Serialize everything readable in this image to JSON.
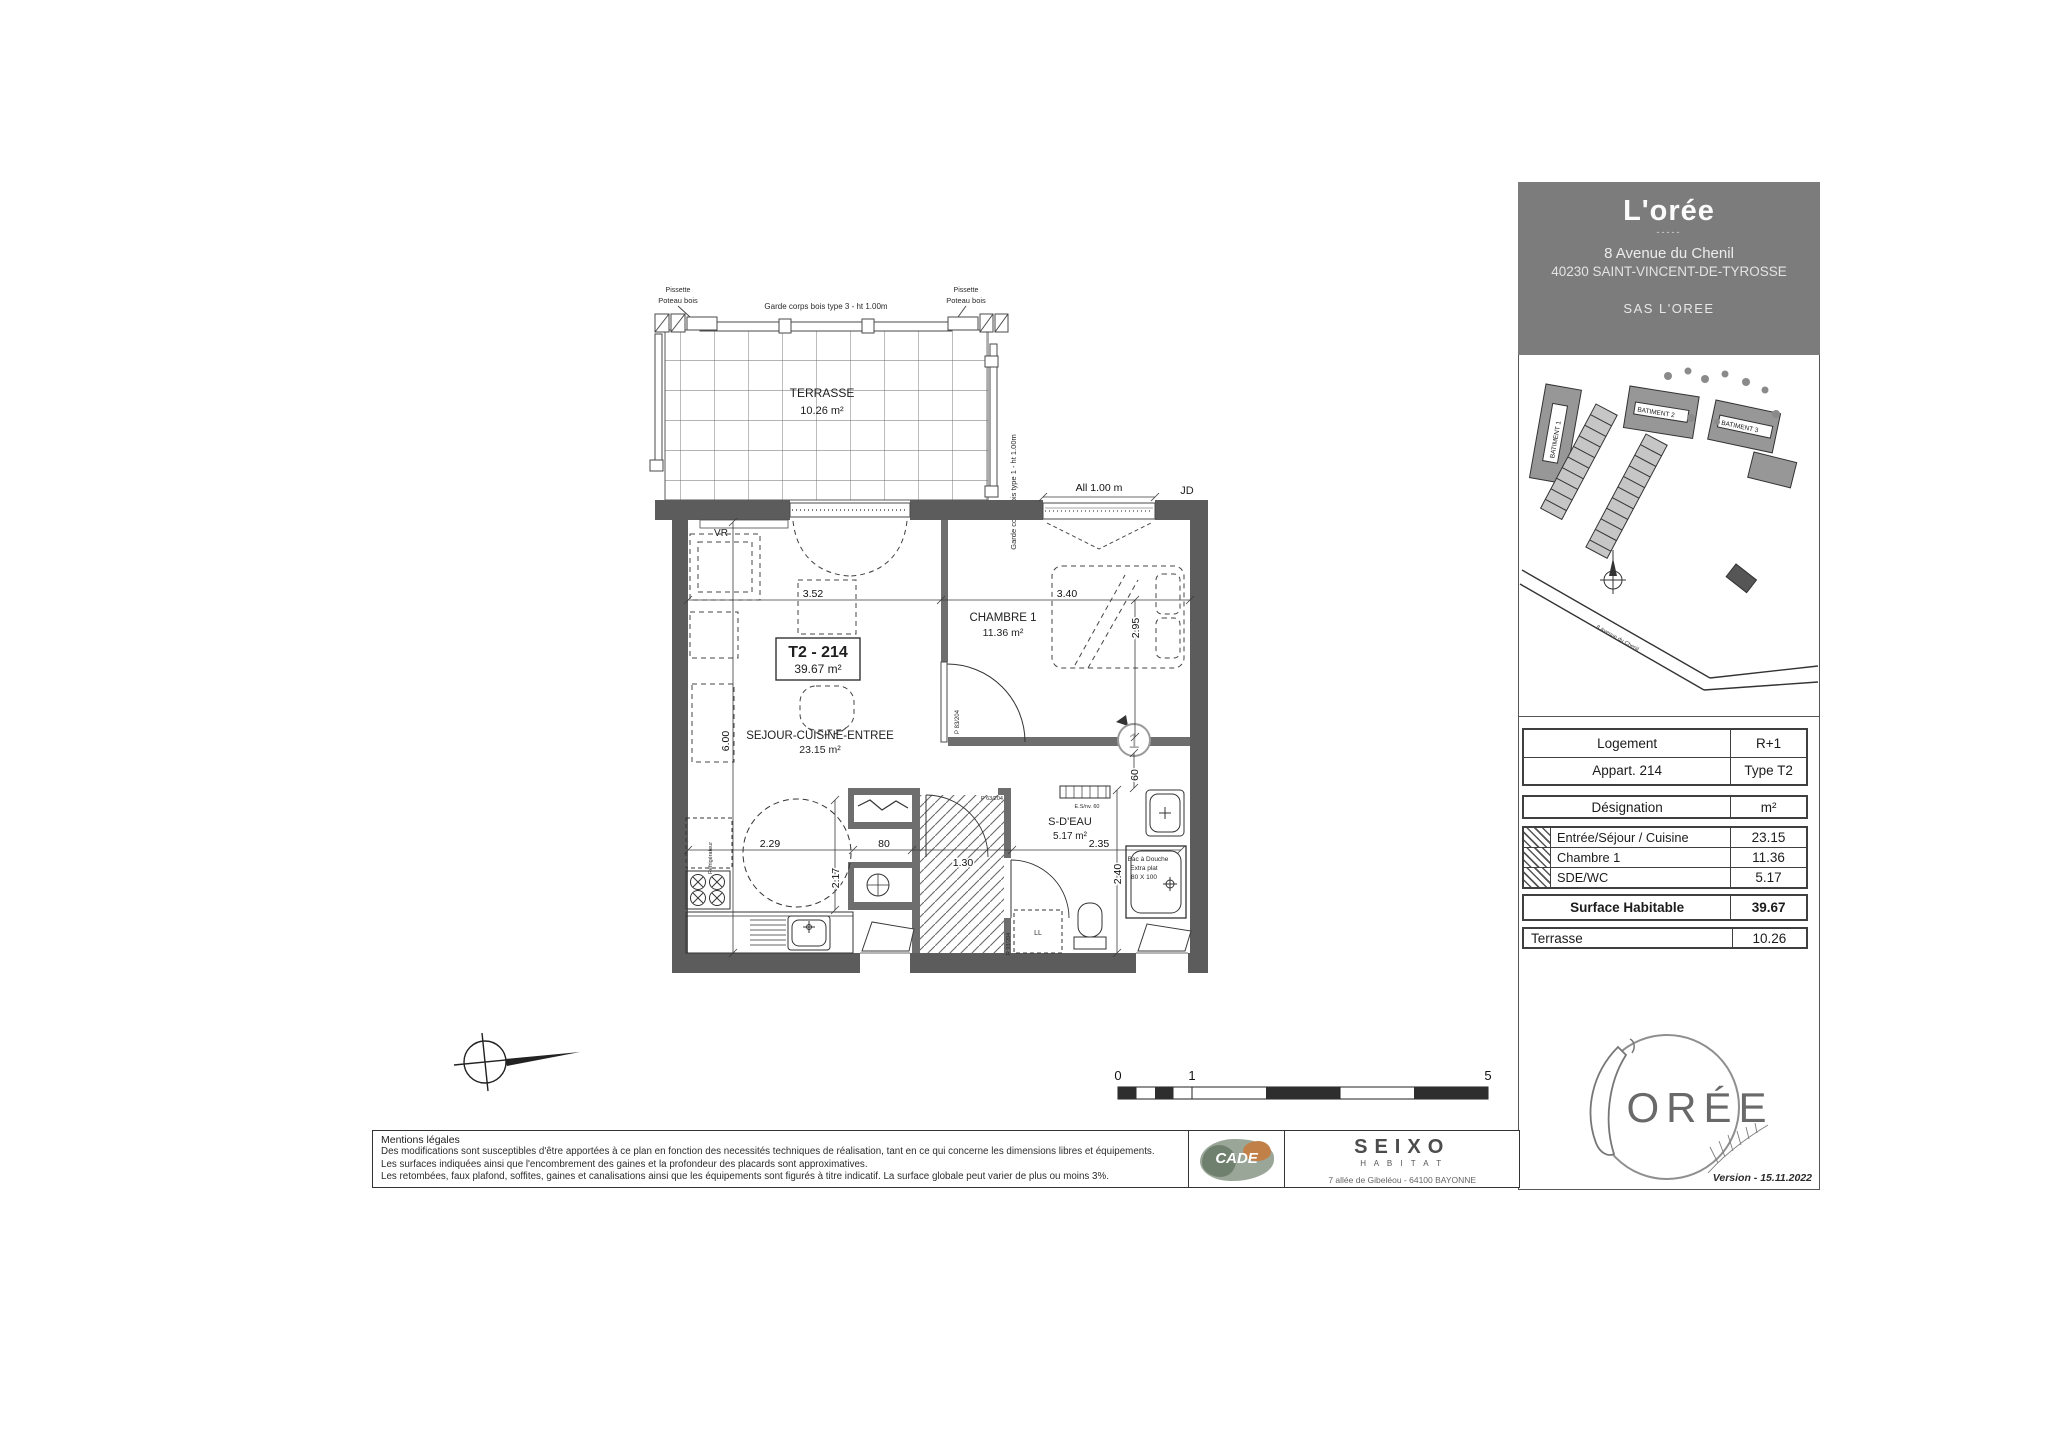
{
  "header": {
    "title": "L'orée",
    "divider": "-----",
    "address1": "8 Avenue du Chenil",
    "address2": "40230 SAINT-VINCENT-DE-TYROSSE",
    "company": "SAS L'OREE"
  },
  "site_plan": {
    "batiment1": "BATIMENT 1",
    "batiment2": "BATIMENT 2",
    "batiment3": "BATIMENT 3",
    "road": "8 Avenue du Chenil"
  },
  "info_table": {
    "logement_label": "Logement",
    "logement_value": "R+1",
    "appart_label": "Appart. 214",
    "appart_value": "Type T2",
    "designation": "Désignation",
    "unit": "m²",
    "rooms": [
      {
        "name": "Entrée/Séjour / Cuisine",
        "area": "23.15"
      },
      {
        "name": "Chambre 1",
        "area": "11.36"
      },
      {
        "name": "SDE/WC",
        "area": "5.17"
      }
    ],
    "total_label": "Surface Habitable",
    "total_value": "39.67",
    "terrasse_label": "Terrasse",
    "terrasse_value": "10.26"
  },
  "floor_plan": {
    "terrasse_name": "TERRASSE",
    "terrasse_area": "10.26 m²",
    "unit_code": "T2 - 214",
    "unit_area": "39.67 m²",
    "sejour_name": "SEJOUR-CUISINE-ENTREE",
    "sejour_area": "23.15 m²",
    "chambre_name": "CHAMBRE 1",
    "chambre_area": "11.36 m²",
    "sdeau_name": "S-D'EAU",
    "sdeau_area": "5.17 m²",
    "garde_corps_top": "Garde corps bois type 3 - ht 1.00m",
    "garde_corps_side": "Garde corps bois type 1 - ht 1.00m",
    "pissette": "Pissette",
    "poteau_bois": "Poteau bois",
    "allege": "All 1.00 m",
    "jd": "JD",
    "vr": "VR",
    "shower_l1": "Bac à Douche",
    "shower_l2": "Extra plat",
    "shower_l3": "80 X 100",
    "door_chambre": "P 83/204",
    "door_sdb": "P 63/204",
    "door_entree": "R 93/204",
    "radiator": "E.S/nv. 60",
    "washer": "LL",
    "fridge": "Réfrigérateur",
    "marker": "1",
    "dims": {
      "sejour_w": "3.52",
      "sejour_h": "6.00",
      "chambre_w": "3.40",
      "chambre_h": "2.95",
      "kitchen_w": "2.29",
      "kitchen_h": "2.17",
      "placard": "80",
      "hall": "1.30",
      "sdeau_w": "2.35",
      "sdeau_h": "2.40",
      "niche": "60"
    }
  },
  "scale_bar": {
    "t0": "0",
    "t1": "1",
    "t5": "5"
  },
  "legal": {
    "title": "Mentions légales",
    "line1": "Des modifications sont susceptibles d'être apportées à ce plan en fonction des necessités techniques de réalisation, tant en ce qui concerne les dimensions libres et équipements.",
    "line2": "Les surfaces indiquées ainsi que l'encombrement des gaines et la profondeur des placards sont approximatives.",
    "line3": "Les retombées, faux plafond, soffites, gaines et canalisations ainsi que les équipements sont figurés à titre indicatif. La surface globale peut varier de plus ou moins 3%."
  },
  "partners": {
    "icade_text": "CADE",
    "seixo": "SEIXO",
    "habitat": "H A B I T A T",
    "seixo_address": "7 allée de Gibeléou  -  64100 BAYONNE"
  },
  "footer": {
    "oree": "ORÉE",
    "version": "Version - 15.11.2022"
  }
}
